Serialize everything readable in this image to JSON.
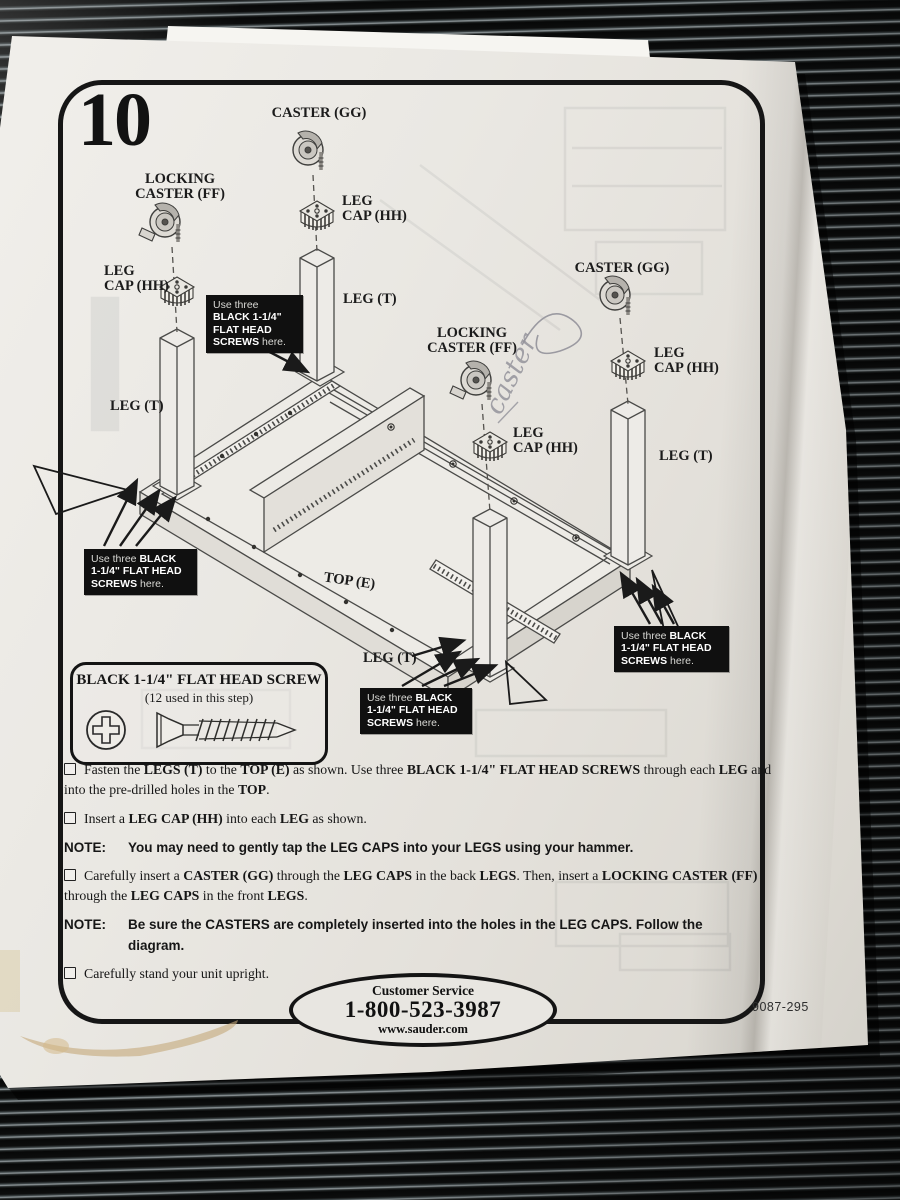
{
  "page": {
    "step_number": "10",
    "part_code": "9087-295"
  },
  "customer_service": {
    "label": "Customer Service",
    "phone": "1-800-523-3987",
    "website": "www.sauder.com"
  },
  "screw_legend": {
    "title": "BLACK 1-1/4\" FLAT HEAD SCREW",
    "subtitle": "(12 used in this step)"
  },
  "annotations": {
    "handwriting": "caster"
  },
  "diagram": {
    "labels": [
      {
        "lines": [
          "CASTER (GG)"
        ],
        "x": 319,
        "y": 117,
        "anchor": "middle"
      },
      {
        "lines": [
          "LOCKING",
          "CASTER (FF)"
        ],
        "x": 180,
        "y": 183,
        "anchor": "middle"
      },
      {
        "lines": [
          "LEG",
          "CAP (HH)"
        ],
        "x": 342,
        "y": 205,
        "anchor": "start"
      },
      {
        "lines": [
          "LEG",
          "CAP (HH)"
        ],
        "x": 104,
        "y": 275,
        "anchor": "start"
      },
      {
        "lines": [
          "LEG (T)"
        ],
        "x": 343,
        "y": 303,
        "anchor": "start"
      },
      {
        "lines": [
          "LEG (T)"
        ],
        "x": 110,
        "y": 410,
        "anchor": "start"
      },
      {
        "lines": [
          "LOCKING",
          "CASTER (FF)"
        ],
        "x": 472,
        "y": 337,
        "anchor": "middle"
      },
      {
        "lines": [
          "CASTER (GG)"
        ],
        "x": 622,
        "y": 272,
        "anchor": "middle"
      },
      {
        "lines": [
          "LEG",
          "CAP (HH)"
        ],
        "x": 513,
        "y": 437,
        "anchor": "start"
      },
      {
        "lines": [
          "LEG",
          "CAP (HH)"
        ],
        "x": 654,
        "y": 357,
        "anchor": "start"
      },
      {
        "lines": [
          "LEG (T)"
        ],
        "x": 659,
        "y": 460,
        "anchor": "start"
      },
      {
        "lines": [
          "LEG (T)"
        ],
        "x": 363,
        "y": 662,
        "anchor": "start"
      },
      {
        "lines": [
          "TOP (E)"
        ],
        "x": 349,
        "y": 585,
        "anchor": "middle",
        "size": 11,
        "rotate": 8
      }
    ],
    "callouts": [
      {
        "x": 206,
        "y": 295,
        "w": 84,
        "lines": [
          [
            {
              "t": "Use three",
              "b": false
            }
          ],
          [
            {
              "t": "BLACK 1-1/4\"",
              "b": true
            }
          ],
          [
            {
              "t": "FLAT HEAD",
              "b": true
            }
          ],
          [
            {
              "t": "SCREWS",
              "b": true
            },
            {
              "t": " here.",
              "b": false
            }
          ]
        ]
      },
      {
        "x": 84,
        "y": 549,
        "w": 100,
        "lines": [
          [
            {
              "t": "Use three ",
              "b": false
            },
            {
              "t": "BLACK",
              "b": true
            }
          ],
          [
            {
              "t": "1-1/4\" FLAT HEAD",
              "b": true
            }
          ],
          [
            {
              "t": "SCREWS",
              "b": true
            },
            {
              "t": " here.",
              "b": false
            }
          ]
        ]
      },
      {
        "x": 360,
        "y": 688,
        "w": 99,
        "lines": [
          [
            {
              "t": "Use three ",
              "b": false
            },
            {
              "t": "BLACK",
              "b": true
            }
          ],
          [
            {
              "t": "1-1/4\" FLAT HEAD",
              "b": true
            }
          ],
          [
            {
              "t": "SCREWS",
              "b": true
            },
            {
              "t": " here.",
              "b": false
            }
          ]
        ]
      },
      {
        "x": 614,
        "y": 626,
        "w": 102,
        "lines": [
          [
            {
              "t": "Use three ",
              "b": false
            },
            {
              "t": "BLACK",
              "b": true
            }
          ],
          [
            {
              "t": "1-1/4\" FLAT HEAD",
              "b": true
            }
          ],
          [
            {
              "t": "SCREWS",
              "b": true
            },
            {
              "t": " here.",
              "b": false
            }
          ]
        ]
      }
    ]
  },
  "steps": [
    {
      "type": "check",
      "segments": [
        {
          "t": "Fasten the ",
          "b": false
        },
        {
          "t": "LEGS (T)",
          "b": true
        },
        {
          "t": " to the ",
          "b": false
        },
        {
          "t": "TOP (E)",
          "b": true
        },
        {
          "t": " as shown.  Use three ",
          "b": false
        },
        {
          "t": "BLACK 1-1/4\" FLAT HEAD SCREWS",
          "b": true
        },
        {
          "t": " through each ",
          "b": false
        },
        {
          "t": "LEG",
          "b": true
        },
        {
          "t": " and into the pre-drilled holes in the ",
          "b": false
        },
        {
          "t": "TOP",
          "b": true
        },
        {
          "t": ".",
          "b": false
        }
      ]
    },
    {
      "type": "check",
      "segments": [
        {
          "t": "Insert a ",
          "b": false
        },
        {
          "t": "LEG CAP (HH)",
          "b": true
        },
        {
          "t": " into each ",
          "b": false
        },
        {
          "t": "LEG",
          "b": true
        },
        {
          "t": " as shown.",
          "b": false
        }
      ]
    },
    {
      "type": "note",
      "label": "NOTE:",
      "text": "You may need to gently tap the LEG CAPS into your LEGS using your hammer."
    },
    {
      "type": "check",
      "segments": [
        {
          "t": "Carefully insert a ",
          "b": false
        },
        {
          "t": "CASTER (GG)",
          "b": true
        },
        {
          "t": " through the ",
          "b": false
        },
        {
          "t": "LEG CAPS",
          "b": true
        },
        {
          "t": " in the back ",
          "b": false
        },
        {
          "t": "LEGS",
          "b": true
        },
        {
          "t": ".  Then, insert a ",
          "b": false
        },
        {
          "t": "LOCKING CASTER (FF)",
          "b": true
        },
        {
          "t": " through the ",
          "b": false
        },
        {
          "t": "LEG CAPS",
          "b": true
        },
        {
          "t": " in the front ",
          "b": false
        },
        {
          "t": "LEGS",
          "b": true
        },
        {
          "t": ".",
          "b": false
        }
      ]
    },
    {
      "type": "note",
      "label": "NOTE:",
      "text": "Be sure the CASTERS are completely inserted into the holes in the LEG CAPS.  Follow the diagram."
    },
    {
      "type": "check",
      "segments": [
        {
          "t": "Carefully stand your unit upright.",
          "b": false
        }
      ]
    }
  ]
}
